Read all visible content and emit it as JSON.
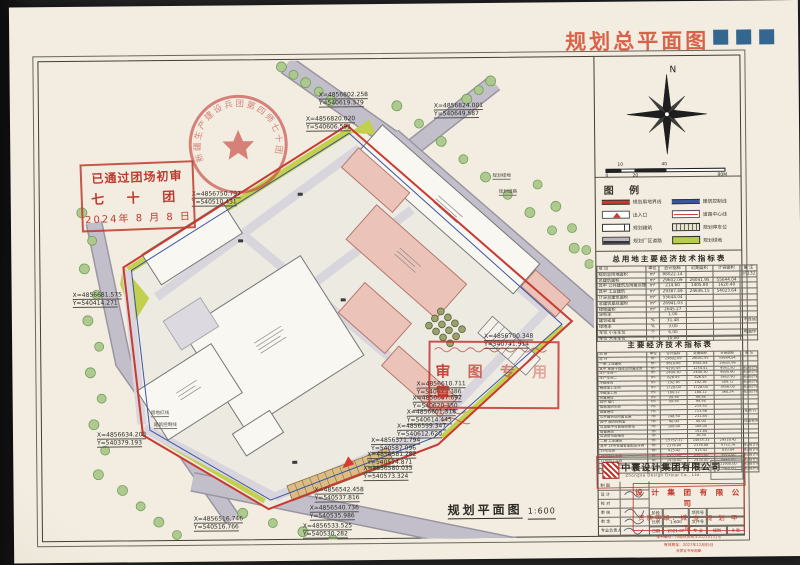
{
  "header": {
    "title": "规划总平面图"
  },
  "plan": {
    "caption": "规划平面图",
    "caption_scale": "1:600",
    "approval_box": {
      "line1": "已通过团场初审",
      "line2": "七 十 团",
      "line3": "2024年 8 月 8 日"
    },
    "round_seal_text": "新疆生产建设兵团第四师七十团",
    "review_stamp": {
      "big_text": "审 图 专 用 章"
    },
    "labels": [
      {
        "text": "规划绿地",
        "left": 482,
        "top": 170
      },
      {
        "text": "规划道路",
        "left": 488,
        "top": 186
      },
      {
        "text": "用地红线",
        "left": 138,
        "top": 404
      },
      {
        "text": "建筑控制线",
        "left": 141,
        "top": 416
      }
    ],
    "coordinates": [
      {
        "x": "X=4856802.258",
        "y": "Y=540619.379",
        "left": 309,
        "top": 87
      },
      {
        "x": "X=4856820.020",
        "y": "Y=540606.591",
        "left": 296,
        "top": 111
      },
      {
        "x": "X=4856824.001",
        "y": "Y=540649.587",
        "left": 424,
        "top": 99
      },
      {
        "x": "X=4856750.797",
        "y": "Y=540510.431",
        "left": 181,
        "top": 185
      },
      {
        "x": "X=4856681.575",
        "y": "Y=540414.271",
        "left": 61,
        "top": 285
      },
      {
        "x": "X=4856634.203",
        "y": "Y=540379.193",
        "left": 84,
        "top": 425
      },
      {
        "x": "X=4856700.348",
        "y": "Y=540741.914",
        "left": 472,
        "top": 330
      },
      {
        "x": "X=4856610.711",
        "y": "Y=540623.386",
        "left": 404,
        "top": 377
      },
      {
        "x": "X=4856607.692",
        "y": "Y=540620.350",
        "left": 400,
        "top": 391
      },
      {
        "x": "X=4856601.318",
        "y": "Y=540614.445",
        "left": 394,
        "top": 405
      },
      {
        "x": "X=4856599.347",
        "y": "Y=540612.620",
        "left": 384,
        "top": 419
      },
      {
        "x": "X=4856571.794",
        "y": "Y=540587.096",
        "left": 358,
        "top": 433
      },
      {
        "x": "X=4856581.282",
        "y": "Y=540574.871",
        "left": 354,
        "top": 447
      },
      {
        "x": "X=4856580.035",
        "y": "Y=540573.324",
        "left": 350,
        "top": 461
      },
      {
        "x": "X=4856542.458",
        "y": "Y=540537.816",
        "left": 301,
        "top": 482
      },
      {
        "x": "X=4856540.736",
        "y": "Y=540535.986",
        "left": 296,
        "top": 500
      },
      {
        "x": "X=4856533.525",
        "y": "Y=540530.282",
        "left": 289,
        "top": 518
      },
      {
        "x": "X=4856516.746",
        "y": "Y=540516.766",
        "left": 180,
        "top": 510
      }
    ]
  },
  "compass": {
    "north_label": "N"
  },
  "scalebar": {
    "labels": [
      "0",
      "10",
      "20",
      "40",
      "80M"
    ]
  },
  "legend": {
    "title": "图  例",
    "items": [
      {
        "label": "规划用地界线"
      },
      {
        "label": "建筑控制线"
      },
      {
        "label": "出入口"
      },
      {
        "label": "道路中心线"
      },
      {
        "label": "规划建筑"
      },
      {
        "label": "规划停车位"
      },
      {
        "label": "规划厂区道路"
      },
      {
        "label": "规划绿地"
      }
    ]
  },
  "table1": {
    "title": "总用地主要经济技术指标表",
    "headers": [
      "项  目",
      "单位",
      "合计指标",
      "近期面积",
      "计容面积",
      "备 注"
    ],
    "rows": [
      [
        "规划总用地面积",
        "m²",
        "88022.14",
        "",
        "",
        "(约132.03亩)"
      ],
      [
        "总建筑面积",
        "m²",
        "29602.09",
        "26041.95",
        "55644.04",
        ""
      ],
      [
        "其中 公共建筑及附属设施",
        "m²",
        "214.60",
        "1405.80",
        "1620.40",
        ""
      ],
      [
        "其中 工业建筑",
        "m²",
        "29387.49",
        "24636.15",
        "54023.64",
        ""
      ],
      [
        "计容总建筑面积",
        "m²",
        "55644.04",
        "",
        "",
        ""
      ],
      [
        "总建筑基底面积",
        "m²",
        "26941.03",
        "",
        "",
        ""
      ],
      [
        "绿地面积",
        "m²",
        "2645.27",
        "",
        "",
        ""
      ],
      [
        "容积率",
        "",
        "1.00",
        "",
        "",
        ""
      ],
      [
        "建筑密度",
        "%",
        "31.48",
        "",
        "",
        "(不含远期)"
      ],
      [
        "绿地率",
        "%",
        "3.00",
        "",
        "",
        ""
      ],
      [
        "车位 小车车位",
        "个",
        "6.00",
        "",
        "",
        "(地面停车位)"
      ],
      [
        "车位 大车车位",
        "个",
        "10.00",
        "",
        "",
        ""
      ]
    ]
  },
  "table2": {
    "title": "主要经济技术指标表",
    "headers": [
      "项  目",
      "单位",
      "合计指标",
      "近期面积",
      "计容面积",
      "备 注"
    ],
    "rows": [
      [
        "总 计",
        "m²",
        "29602.09",
        "26041.95",
        "55644.04",
        ""
      ],
      [
        "一期 工业建筑",
        "m²",
        "9618.68",
        "6581.64",
        "15605.96",
        ""
      ],
      [
        "其中 单层干燥库及附属库房",
        "m²",
        "4291.45",
        "1254.41",
        "4951.50",
        "按2倍计容"
      ],
      [
        "生产车间一",
        "m²",
        "2400.30",
        "2400.30",
        "4800.60",
        "按2倍计容"
      ],
      [
        "生产车间二",
        "m²",
        "826.45",
        "826.45",
        "1652.90",
        "按2倍计容"
      ],
      [
        "冷链库房",
        "m²",
        "192.36",
        "192.36",
        "384.72",
        "按2倍计容"
      ],
      [
        "精选加工车间",
        "m²",
        "1728.00",
        "1728.00",
        "3456.00",
        "按2倍计容"
      ],
      [
        "冷藏加工间",
        "m²",
        "180.12",
        "180.12",
        "360.24",
        "按2倍计容"
      ],
      [
        "附属用房",
        "m²",
        "99.56",
        "99.56",
        "",
        ""
      ],
      [
        "其中 餐厅",
        "m²",
        "99.56",
        "99.56",
        "",
        ""
      ],
      [
        "成品消防水池",
        "m²",
        "",
        "215.50",
        "",
        ""
      ],
      [
        "设备用房",
        "m²",
        "",
        "713.56",
        "",
        "(在地下)"
      ],
      [
        "公共建筑及附属设施",
        "m²",
        "148.50",
        "231.84",
        "",
        ""
      ],
      [
        "其中 消防控制室",
        "m²",
        "40.00",
        "40.00",
        "",
        "(成品板房)"
      ],
      [
        "垃圾集中与智能收集站",
        "m²",
        "108.00",
        "108.00",
        "",
        ""
      ],
      [
        "设备用房",
        "m²",
        "",
        "191.84",
        "",
        ""
      ],
      [
        "垃圾房与配电房",
        "m²",
        "",
        "16.50",
        "",
        ""
      ],
      [
        "二期 工业建筑",
        "m²",
        "15752.31",
        "14935.33",
        "29518.42",
        ""
      ],
      [
        "其中 14号仓储智能配送车间",
        "m²",
        "2376.88",
        "2376.88",
        "4753.76",
        "按2倍计容"
      ],
      [
        "15号车间",
        "m²",
        "415.42",
        "415.42",
        "830.84",
        "按2倍计容"
      ],
      [
        "16号加工车间",
        "m²",
        "2955.00",
        "2955.00",
        "5910.00",
        "按2倍计容"
      ],
      [
        "17号加工车间",
        "m²",
        "2430.00",
        "2430.00",
        "4860.00",
        "按2倍计容"
      ],
      [
        "18号加工车间",
        "m²",
        "5950.00",
        "5950.00",
        "11900.00",
        "按2倍计容"
      ],
      [
        "19号库房",
        "m²",
        "1480.00",
        "1480.00",
        "2960.00",
        "按2倍计容"
      ]
    ]
  },
  "titleblock": {
    "company_cn": "中寰设计集团有限公司",
    "company_en": "Zhongxa Design Group Co., Ltd.",
    "cert_stamp": {
      "line1": "设 计 集 团 有 限 公 司",
      "line2": "资质等级：城 乡 规 划 甲 级",
      "line3": "证书编号：川自然资规字20210131号",
      "line4": "有效期至：2027年12月05日",
      "line5": "资质证书专用章"
    },
    "sign_rows": [
      "制 图",
      "设 计",
      "校 对",
      "审 核",
      "审 定",
      "专业负责人"
    ],
    "info": {
      "stage_label": "阶段",
      "stage": "",
      "scale_label": "比例",
      "scale": "1:600",
      "date_label": "日期",
      "date": "2021.07",
      "project_label": "项目号",
      "project": "",
      "file_label": "文件号",
      "file": "",
      "major_label": "专 业",
      "major": "规划",
      "sheet": "9 张"
    }
  },
  "colors": {
    "paper": "#f2ede0",
    "header_accent": "#d7644a",
    "square_blue": "#34678f",
    "boundary_red": "#c93a33",
    "control_blue": "#3b55a5",
    "building_pink": "#ecc3b8",
    "green": "#c2d04e",
    "road_gray": "#c3bfca",
    "stamp_red": "#bf3a2e"
  }
}
